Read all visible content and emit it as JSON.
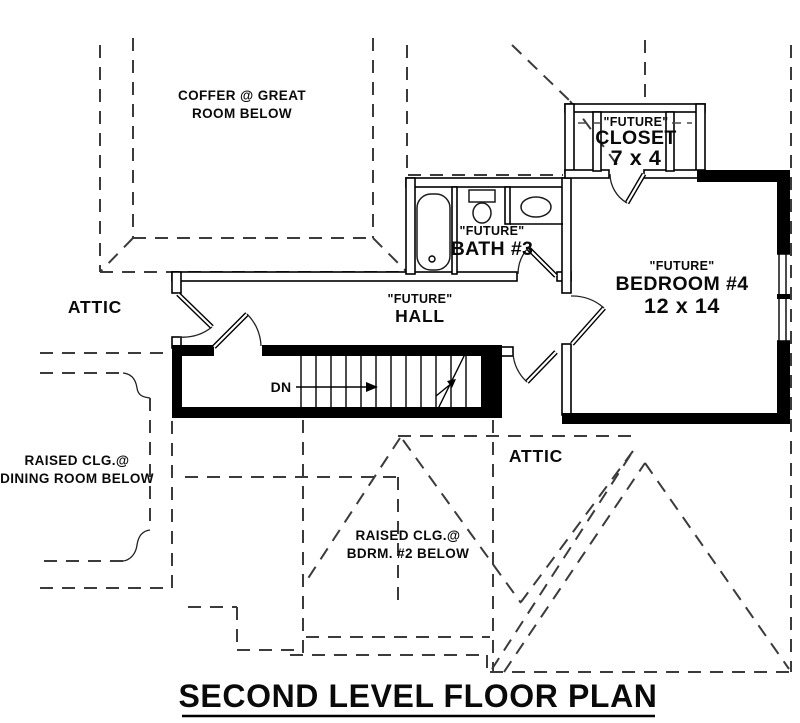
{
  "title": "SECOND LEVEL FLOOR PLAN",
  "colors": {
    "background": "#ffffff",
    "solid_line": "#000000",
    "dashed_line": "#3b3b3b",
    "wall_fill": "#000000"
  },
  "labels": {
    "coffer_line1": "COFFER @ GREAT",
    "coffer_line2": "ROOM BELOW",
    "attic_left": "ATTIC",
    "attic_right": "ATTIC",
    "hall_prefix": "\"FUTURE\"",
    "hall_name": "HALL",
    "bath_prefix": "\"FUTURE\"",
    "bath_name": "BATH #3",
    "closet_prefix": "\"FUTURE\"",
    "closet_name": "CLOSET",
    "closet_dims": "7 x 4",
    "bedroom_prefix": "\"FUTURE\"",
    "bedroom_name": "BEDROOM #4",
    "bedroom_dims": "12 x 14",
    "dining_line1": "RAISED CLG.@",
    "dining_line2": "DINING ROOM BELOW",
    "bdrm2_line1": "RAISED CLG.@",
    "bdrm2_line2": "BDRM. #2 BELOW",
    "stairs_direction": "DN"
  }
}
